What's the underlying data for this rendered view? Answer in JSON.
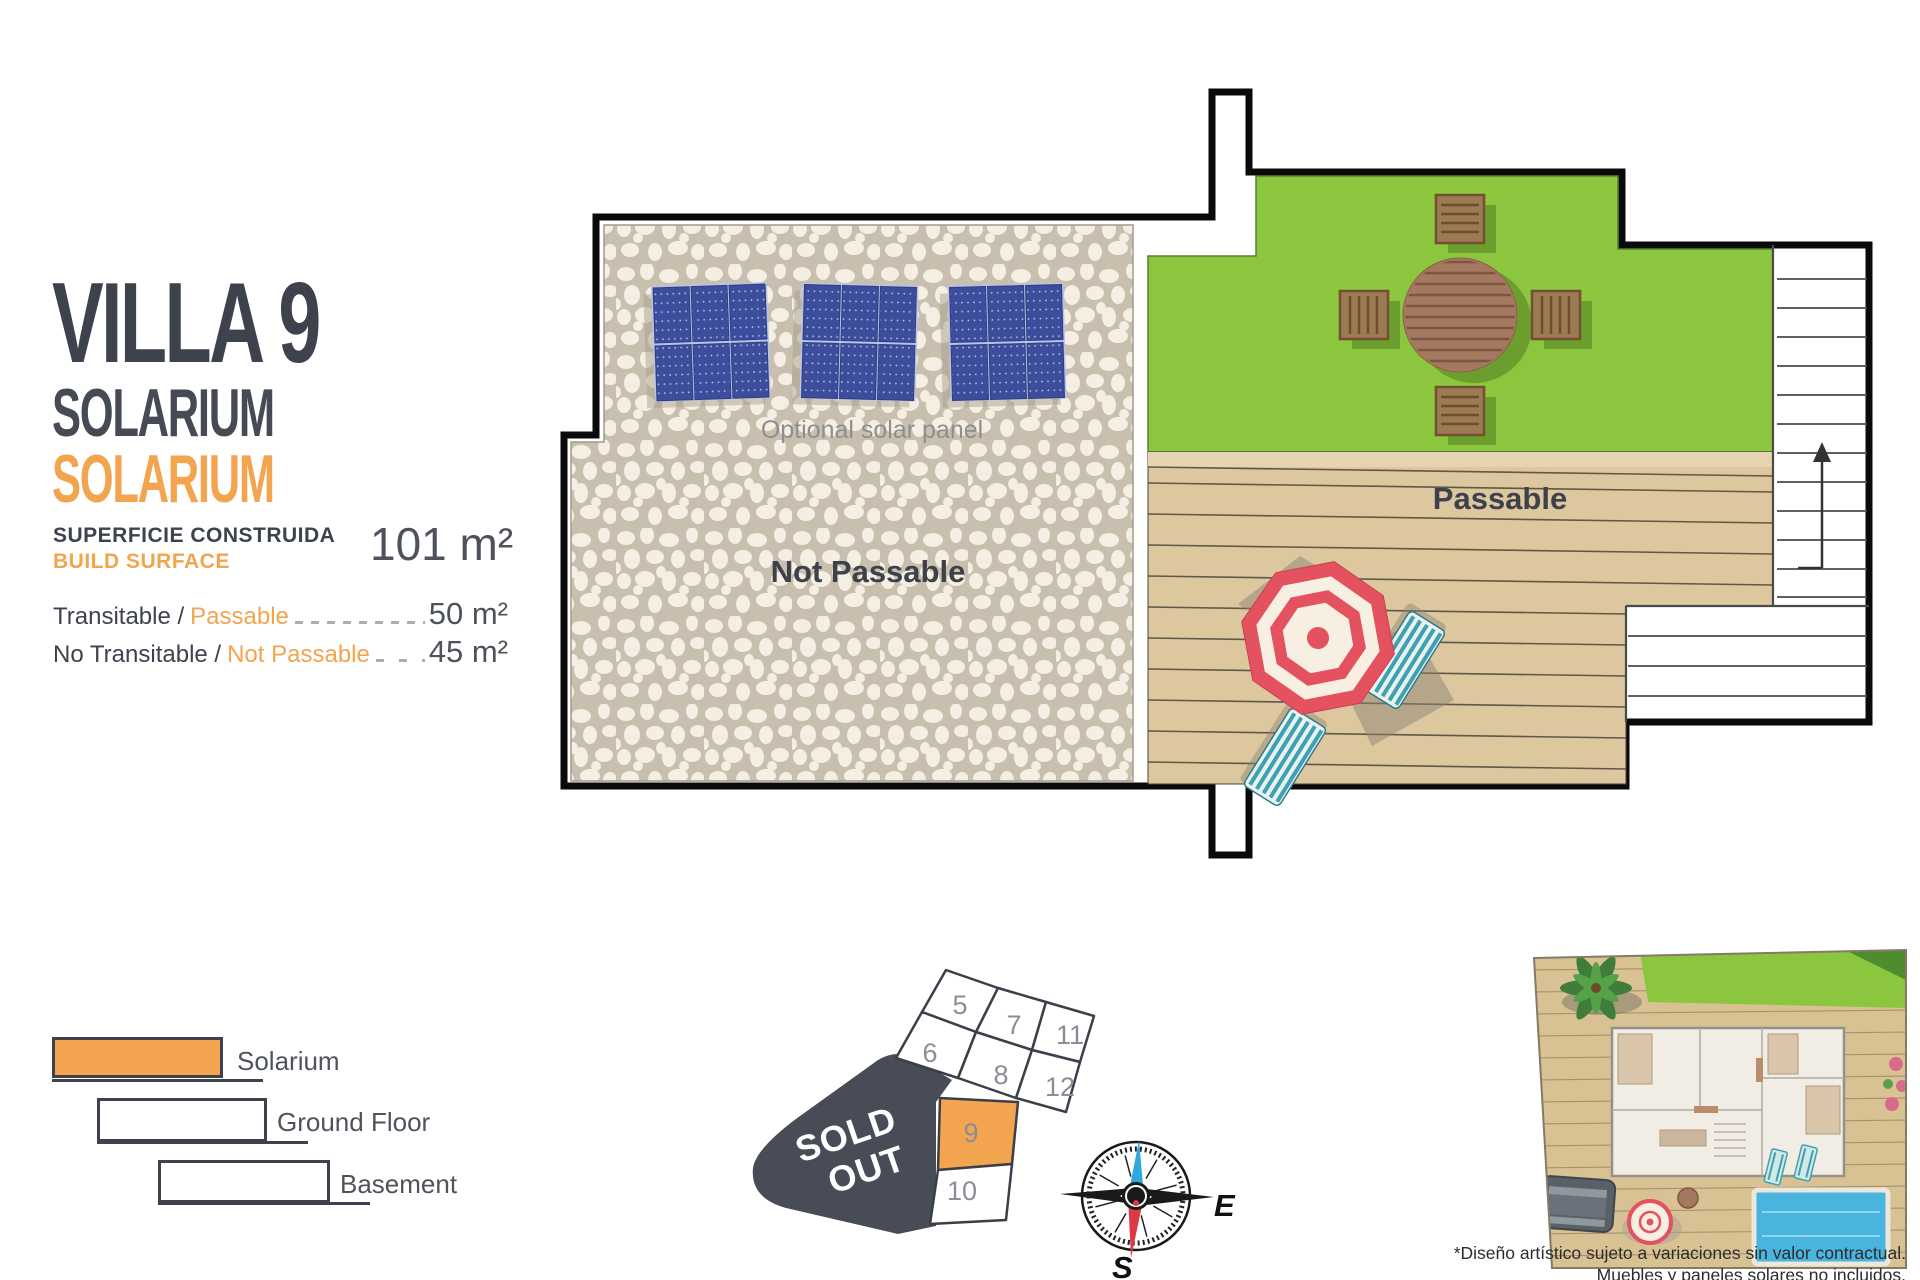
{
  "header": {
    "title": "VILLA 9",
    "subtitle": "SOLARIUM",
    "subtitle_accent": "SOLARIUM"
  },
  "build_surface": {
    "label_es": "SUPERFICIE CONSTRUIDA",
    "label_en": "BUILD SURFACE",
    "value": "101 m²"
  },
  "areas": [
    {
      "label_es": "Transitable /",
      "label_en": "Passable",
      "value": "50 m²"
    },
    {
      "label_es": "No Transitable /",
      "label_en": "Not Passable",
      "value": "45 m²"
    }
  ],
  "legend": [
    {
      "label": "Solarium",
      "filled": "true"
    },
    {
      "label": "Ground Floor",
      "filled": "false"
    },
    {
      "label": "Basement",
      "filled": "false"
    }
  ],
  "plan": {
    "optional_solar_label": "Optional solar panel",
    "not_passable_label": "Not Passable",
    "passable_label": "Passable"
  },
  "site_map": {
    "sold_out_line1": "SOLD",
    "sold_out_line2": "OUT",
    "highlighted_plot": "9",
    "plots": [
      {
        "n": "5"
      },
      {
        "n": "7"
      },
      {
        "n": "11"
      },
      {
        "n": "6"
      },
      {
        "n": "8"
      },
      {
        "n": "12"
      },
      {
        "n": "9"
      },
      {
        "n": "10"
      }
    ]
  },
  "compass": {
    "east": "E",
    "south": "S"
  },
  "disclaimer": {
    "line1": "*Diseño artístico sujeto a variaciones sin valor contractual.",
    "line2": "Muebles y paneles solares no incluidos."
  },
  "colors": {
    "accent_orange": "#F2A44E",
    "dark": "#3D424D",
    "lawn_green": "#8CC63F",
    "deck_wood": "#DCC79E",
    "stone_bg": "#C9BFAE",
    "panel_blue": "#3C4D9C",
    "sold_out_bg": "#474C57",
    "umbrella_red": "#E4515F",
    "lounger_teal": "#3FA0B4",
    "compass_blue": "#2FA8DC",
    "compass_red": "#D93A44"
  }
}
